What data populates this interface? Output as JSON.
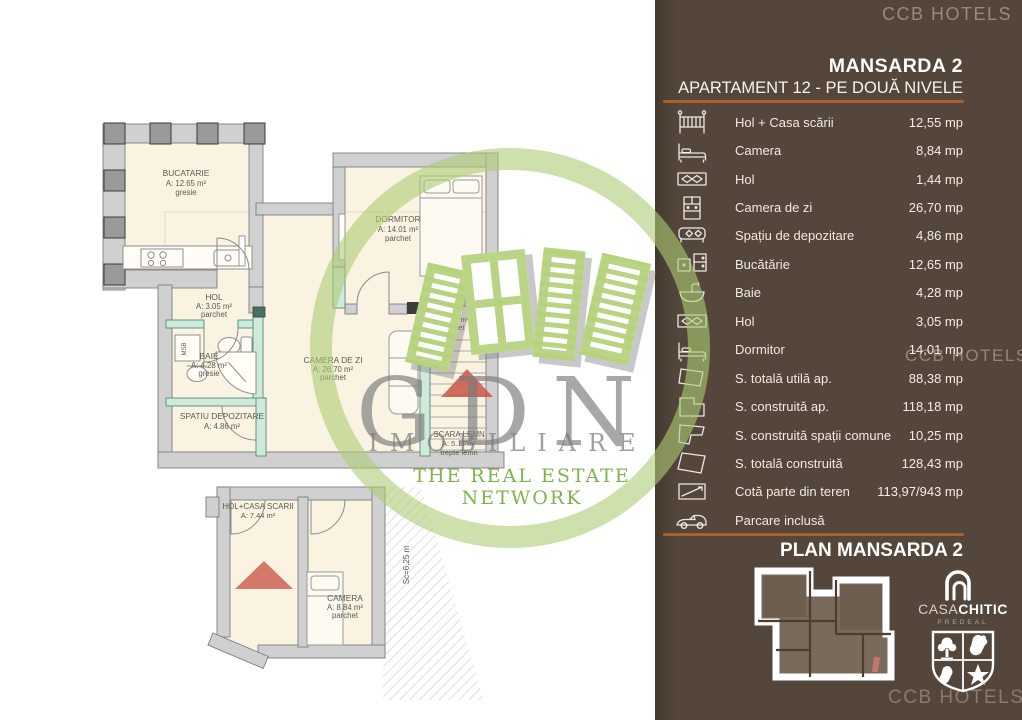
{
  "watermark": {
    "monogram": "GDN",
    "name": "IMOBILIARE",
    "tagline": "THE REAL ESTATE NETWORK"
  },
  "colors": {
    "sidebar_bg": "#54463A",
    "divider_accent": "#A9622E",
    "plan_floor": "#FAF3E1",
    "wall_gray": "#D0D0D0",
    "partition_teal": "#CFE9DB",
    "watermark_green": "#B5D17C",
    "tagline_green": "#76B043",
    "red_accent": "#D4796A"
  },
  "sidebar": {
    "top_watermark": "CCB HOTELS",
    "title": "MANSARDA 2",
    "subtitle": "APARTAMENT 12 - PE DOUĂ NIVELE",
    "mid_watermark": "CCB HOTELS",
    "plan_heading": "PLAN MANSARDA 2",
    "bottom_watermark": "CCB HOTELS",
    "rows": [
      {
        "icon": "crib-icon",
        "label": "Hol + Casa scării",
        "value": "12,55 mp"
      },
      {
        "icon": "bed-icon",
        "label": "Camera",
        "value": "8,84 mp"
      },
      {
        "icon": "rug-icon",
        "label": "Hol",
        "value": "1,44 mp"
      },
      {
        "icon": "cabinet-icon",
        "label": "Camera de zi",
        "value": "26,70 mp"
      },
      {
        "icon": "storage-bench-icon",
        "label": "Spațiu de depozitare",
        "value": "4,86 mp"
      },
      {
        "icon": "kitchen-icon",
        "label": "Bucătărie",
        "value": "12,65 mp"
      },
      {
        "icon": "sink-icon",
        "label": "Baie",
        "value": "4,28 mp"
      },
      {
        "icon": "rug-icon",
        "label": "Hol",
        "value": "3,05 mp"
      },
      {
        "icon": "bed-icon",
        "label": "Dormitor",
        "value": "14,01 mp"
      },
      {
        "icon": "area-outline-icon",
        "label": "S. totală utilă ap.",
        "value": "88,38 mp"
      },
      {
        "icon": "area-outline-icon",
        "label": "S. construită ap.",
        "value": "118,18 mp"
      },
      {
        "icon": "area-outline-icon",
        "label": "S. construită spații comune",
        "value": "10,25 mp"
      },
      {
        "icon": "area-outline-icon",
        "label": "S. totală construită",
        "value": "128,43 mp"
      },
      {
        "icon": "land-share-icon",
        "label": "Cotă parte din teren",
        "value": "113,97/943 mp"
      },
      {
        "icon": "car-icon",
        "label": "Parcare inclusă",
        "value": ""
      }
    ],
    "logo": {
      "casa": "CASA",
      "chitic": "CHITIC",
      "predeal": "PREDEAL"
    }
  },
  "floor_plan": {
    "upper": {
      "washer_label": "MSB",
      "rooms": {
        "bucatarie": {
          "name": "BUCATARIE",
          "area": "A: 12.65 m²",
          "floor": "gresie"
        },
        "hol": {
          "name": "HOL",
          "area": "A: 3.05 m²",
          "floor": "parchet"
        },
        "dormitor": {
          "name": "DORMITOR",
          "area": "A: 14.01 m²",
          "floor": "parchet"
        },
        "baie": {
          "name": "BAIE",
          "area": "A: 4.28 m²",
          "floor": "gresie"
        },
        "camera_de_zi": {
          "name": "CAMERA DE ZI",
          "area": "A: 26.70 m²",
          "floor": "parchet"
        },
        "spatiu_depozitare": {
          "name": "SPATIU DEPOZITARE",
          "area": "A: 4.86 m²"
        },
        "hol_mic": {
          "name": "HOL",
          "area": "A: 1.44 m²",
          "floor": "parchet"
        },
        "scara_lemn": {
          "name": "SCARA LEMN",
          "area": "A: 5.11 m²",
          "floor": "trepte lemn"
        }
      }
    },
    "lower": {
      "scale_note": "Sc=6,25 m",
      "rooms": {
        "hol_casa_scarii": {
          "name": "HOL+CASA SCARII",
          "area": "A: 7.44 m²"
        },
        "camera": {
          "name": "CAMERA",
          "area": "A: 8.84 m²",
          "floor": "parchet"
        }
      }
    }
  }
}
